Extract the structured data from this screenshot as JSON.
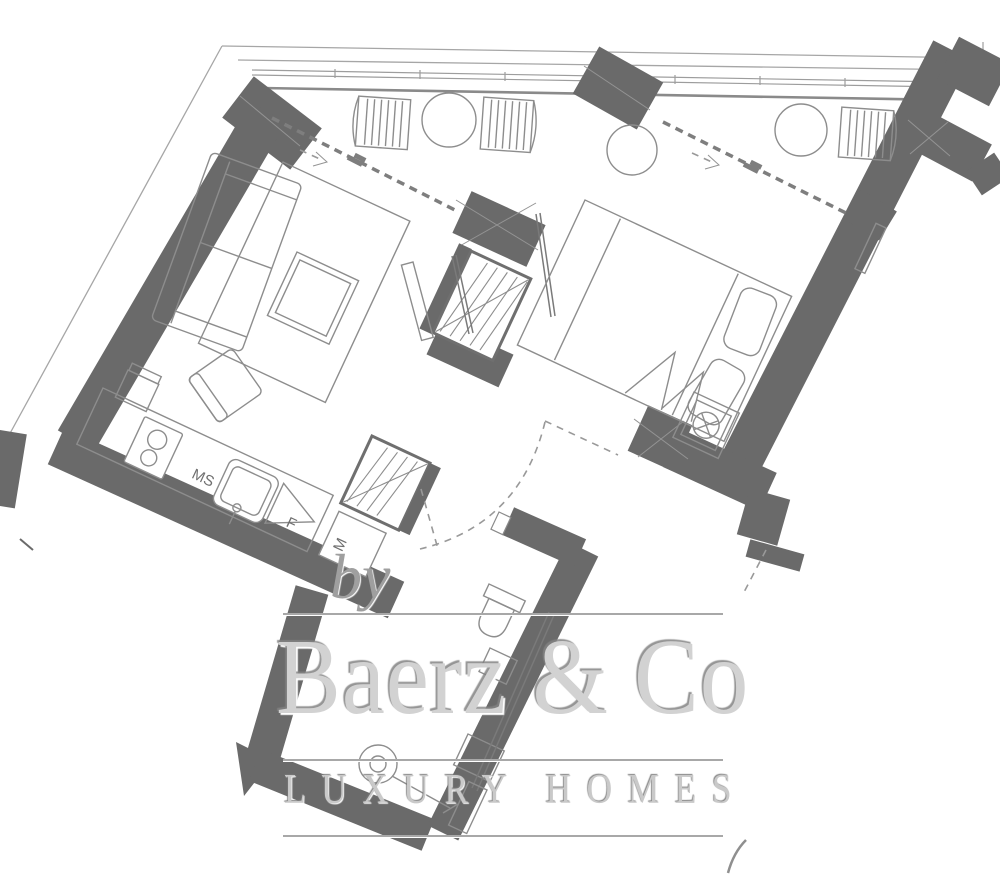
{
  "watermark": {
    "prefix": "by",
    "brand": "Baerz & Co",
    "tagline": "LUXURY HOMES"
  },
  "labels": {
    "hob_ms": "MS",
    "fridge_f": "F",
    "appliance_m": "M"
  },
  "colors": {
    "wall": "#6a6a6a",
    "furniture_line": "#8d8d8d",
    "boundary_line": "#a6a6a6",
    "watermark_gray": "#cfcfcf"
  }
}
